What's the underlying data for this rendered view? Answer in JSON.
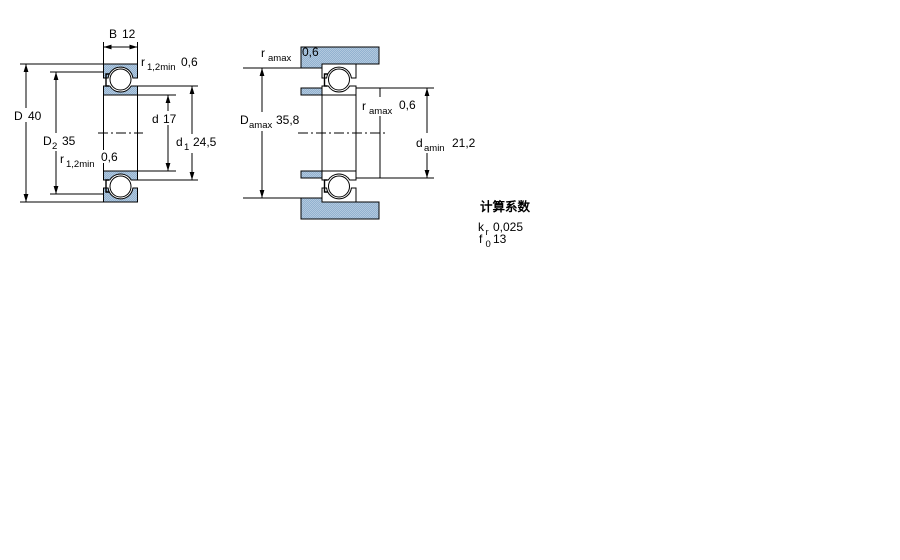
{
  "drawing": {
    "type": "bearing technical drawing",
    "colors": {
      "steel_fill_light": "#b2c8de",
      "steel_fill_dark": "#92b2d0",
      "line": "#000000",
      "background": "#ffffff"
    },
    "cross_section_view": {
      "width_dim": {
        "sym": "B",
        "val": "12"
      },
      "outer_diameter": {
        "sym": "D",
        "val": "40"
      },
      "recess_diameter": {
        "sym": "D",
        "sub": "2",
        "val": "35"
      },
      "bore_diameter": {
        "sym": "d",
        "val": "17"
      },
      "shoulder_diameter": {
        "sym": "d",
        "sub": "1",
        "val": "24,5"
      },
      "chamfer_top": {
        "sym": "r",
        "sub": "1,2min",
        "val": "0,6"
      },
      "chamfer_bottom": {
        "sym": "r",
        "sub": "1,2min",
        "val": "0,6"
      }
    },
    "abutment_view": {
      "housing_fillet": {
        "sym": "r",
        "sub": "amax",
        "val": "0,6"
      },
      "housing_abutment_diameter": {
        "sym": "D",
        "sub": "amax",
        "val": "35,8"
      },
      "shaft_fillet": {
        "sym": "r",
        "sub": "amax",
        "val": "0,6"
      },
      "shaft_abutment_diameter": {
        "sym": "d",
        "sub": "amin",
        "val": "21,2"
      }
    },
    "calculation_factors": {
      "heading": "计算系数",
      "factors": [
        {
          "sym": "k",
          "sub": "r",
          "val": "0,025"
        },
        {
          "sym": "f",
          "sub": "0",
          "val": "13"
        }
      ]
    }
  }
}
